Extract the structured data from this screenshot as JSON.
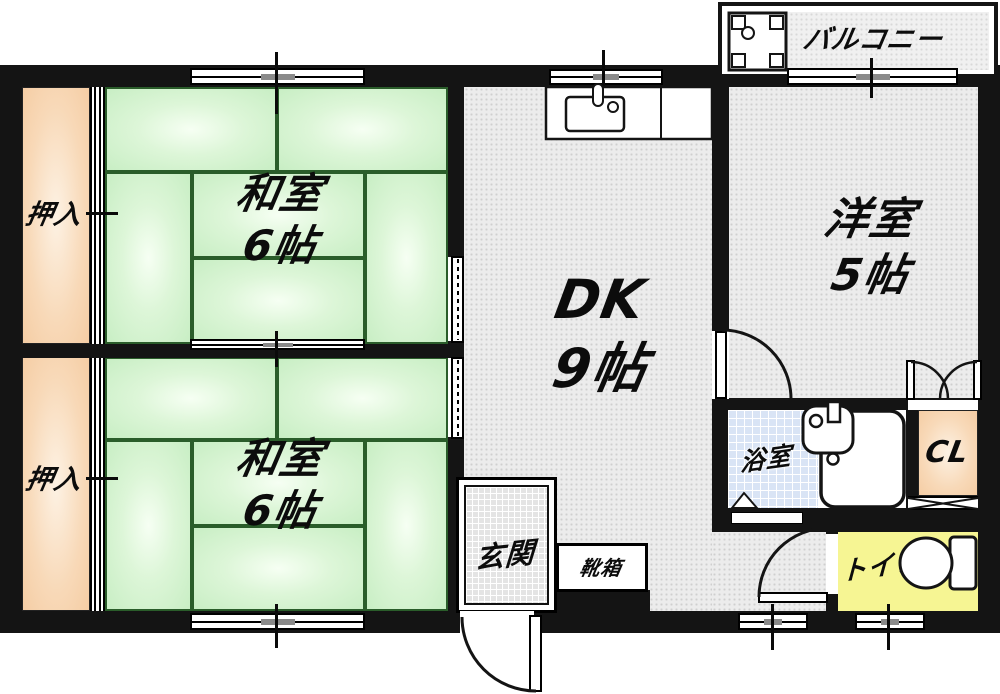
{
  "rooms": {
    "balcony": {
      "label": "バルコニー"
    },
    "washitsu_top": {
      "name": "和室",
      "size": "6帖"
    },
    "washitsu_bottom": {
      "name": "和室",
      "size": "6帖"
    },
    "dk": {
      "name": "DK",
      "size": "9帖"
    },
    "youshitsu": {
      "name": "洋室",
      "size": "5帖"
    },
    "oshiire_top": {
      "label": "押入"
    },
    "oshiire_bottom": {
      "label": "押入"
    },
    "bathroom": {
      "label": "浴室"
    },
    "closet": {
      "label": "CL"
    },
    "toilet": {
      "label": "トイレ"
    },
    "genkan": {
      "label": "玄関"
    },
    "shoebox": {
      "label": "靴箱"
    }
  },
  "colors": {
    "wall_black": "#141414",
    "tatami_green": "#c8eec4",
    "closet_peach": "#f8d9b8",
    "bathroom_blue": "#d9e4f5",
    "toilet_yellow": "#f6f593",
    "floor_gray": "#ececec"
  }
}
